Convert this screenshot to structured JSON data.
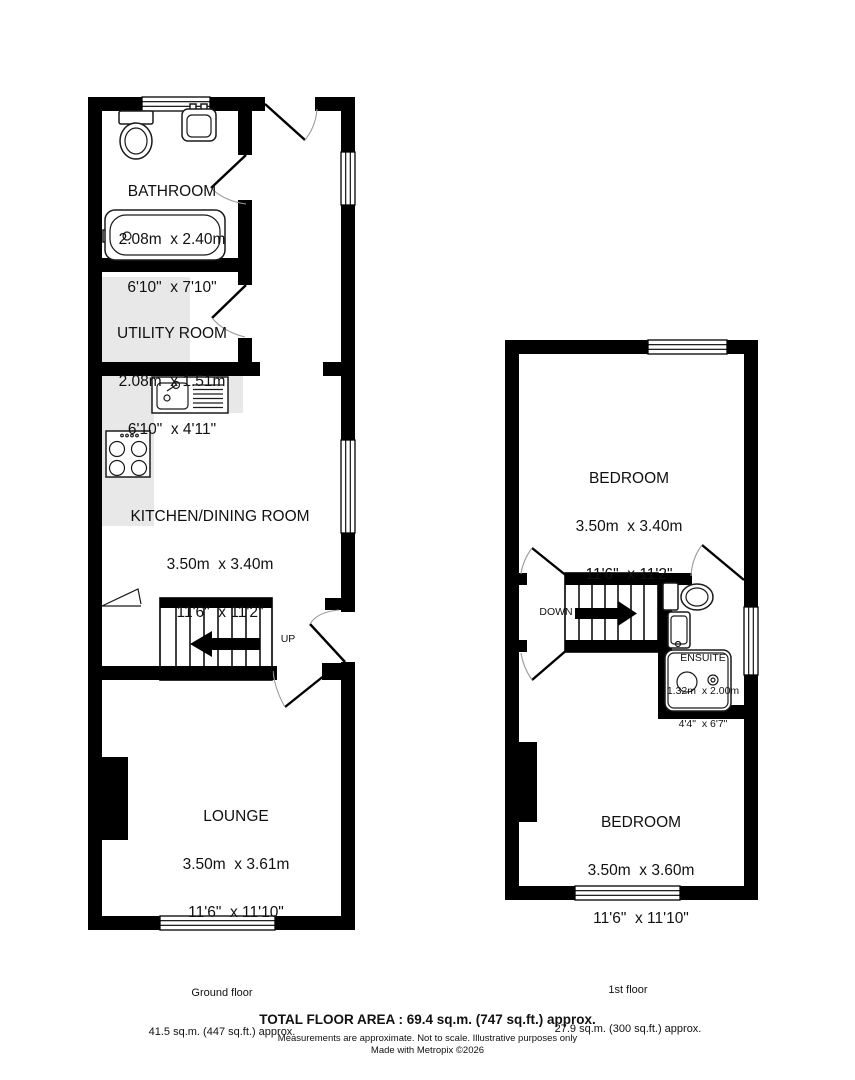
{
  "title": "Property floor plan",
  "colors": {
    "wall": "#000000",
    "counter": "#e8e8e8",
    "door_arc": "#9a9a9a"
  },
  "ground_floor": {
    "rooms": [
      {
        "name": "BATHROOM",
        "metric": "2.08m  x 2.40m",
        "imperial": "6'10\"  x 7'10\""
      },
      {
        "name": "UTILITY ROOM",
        "metric": "2.08m  x 1.51m",
        "imperial": "6'10\"  x 4'11\""
      },
      {
        "name": "KITCHEN/DINING ROOM",
        "metric": "3.50m  x 3.40m",
        "imperial": "11'6\"  x 11'2\""
      },
      {
        "name": "LOUNGE",
        "metric": "3.50m  x 3.61m",
        "imperial": "11'6\"  x 11'10\""
      }
    ],
    "stair_label": "UP",
    "area_label": "Ground floor",
    "area_value": "41.5 sq.m. (447 sq.ft.) approx."
  },
  "first_floor": {
    "rooms": [
      {
        "name": "BEDROOM",
        "metric": "3.50m  x 3.40m",
        "imperial": "11'6\"  x 11'2\""
      },
      {
        "name": "ENSUITE",
        "metric": "1.32m  x 2.00m",
        "imperial": "4'4\"  x 6'7\""
      },
      {
        "name": "BEDROOM",
        "metric": "3.50m  x 3.60m",
        "imperial": "11'6\"  x 11'10\""
      }
    ],
    "stair_label": "DOWN",
    "area_label": "1st floor",
    "area_value": "27.9 sq.m. (300 sq.ft.) approx."
  },
  "footer": {
    "total_area": "TOTAL FLOOR AREA : 69.4 sq.m. (747 sq.ft.) approx.",
    "disclaimer": "Measurements are approximate.  Not to scale.  Illustrative purposes only",
    "credit": "Made with Metropix ©2026"
  }
}
